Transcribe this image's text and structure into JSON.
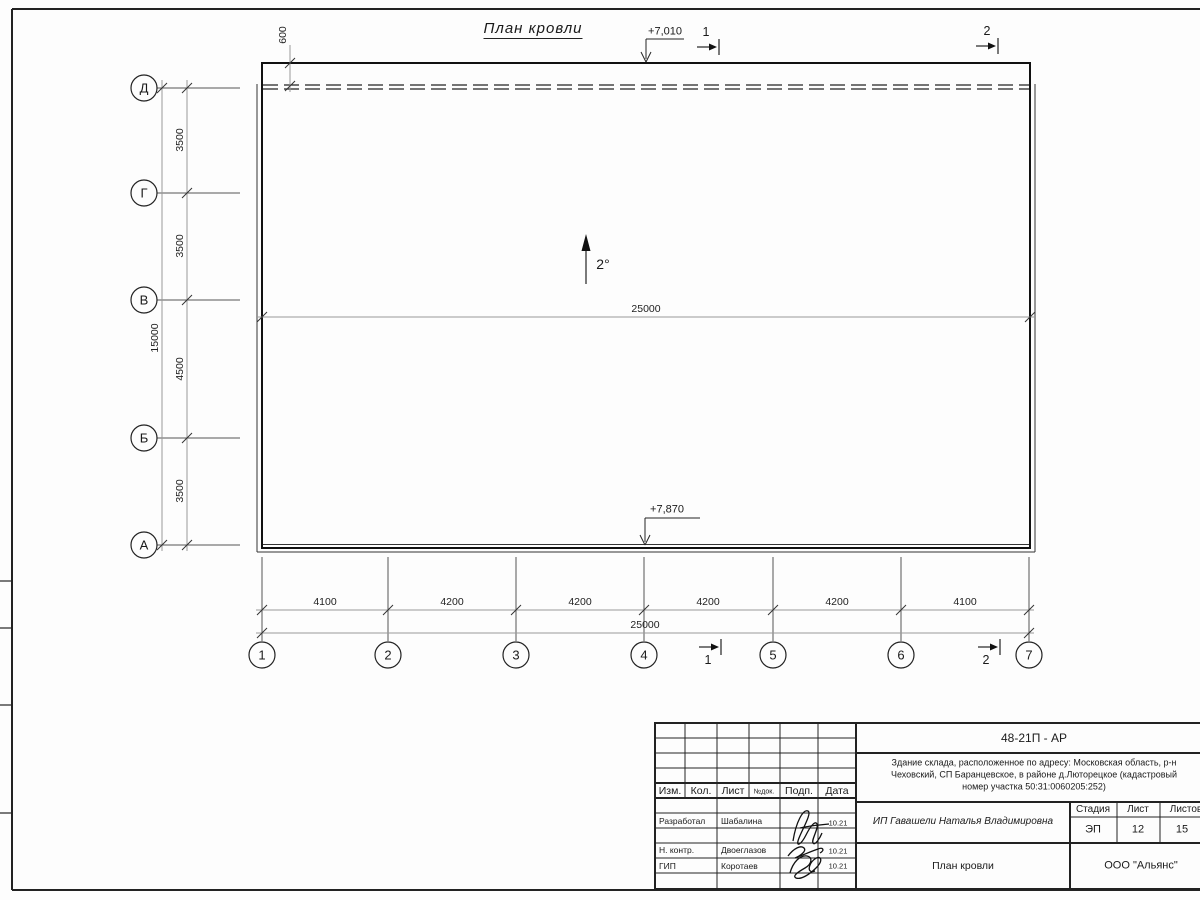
{
  "sheet": {
    "title": "План кровли",
    "slope": "2°",
    "elev_top": "+7,010",
    "elev_bottom": "+7,870",
    "dim_600": "600",
    "dim_inner_total": "25000",
    "section_1": "1",
    "section_2": "2"
  },
  "axes": {
    "cols": [
      "1",
      "2",
      "3",
      "4",
      "5",
      "6",
      "7"
    ],
    "rows": [
      "Д",
      "Г",
      "В",
      "Б",
      "А"
    ],
    "col_dims": [
      "4100",
      "4200",
      "4200",
      "4200",
      "4200",
      "4100"
    ],
    "col_total": "25000",
    "row_dims": [
      "3500",
      "3500",
      "4500",
      "3500"
    ],
    "row_total": "15000"
  },
  "title_block": {
    "doc_number": "48-21П - АР",
    "project_line1": "Здание склада, расположенное по адресу: Московская область, р-н",
    "project_line2": "Чеховский, СП Баранцевское, в районе д.Люторецкое  (кадастровый",
    "project_line3": "номер участка 50:31:0060205:252)",
    "client": "ИП Гавашели Наталья Владимировна",
    "sheet_name": "План кровли",
    "company": "ООО \"Альянс\"",
    "stage_label": "Стадия",
    "sheet_label": "Лист",
    "sheets_label": "Листов",
    "stage_value": "ЭП",
    "sheet_value": "12",
    "sheets_value": "15",
    "col_izm": "Изм.",
    "col_kol": "Кол.",
    "col_list": "Лист",
    "col_ndok": "№док.",
    "col_podp": "Подп.",
    "col_data": "Дата",
    "roles": [
      {
        "role": "Разработал",
        "name": "Шабалина",
        "date": "10.21"
      },
      {
        "role": "Н. контр.",
        "name": "Двоеглазов",
        "date": "10.21"
      },
      {
        "role": "ГИП",
        "name": "Коротаев",
        "date": "10.21"
      }
    ]
  }
}
